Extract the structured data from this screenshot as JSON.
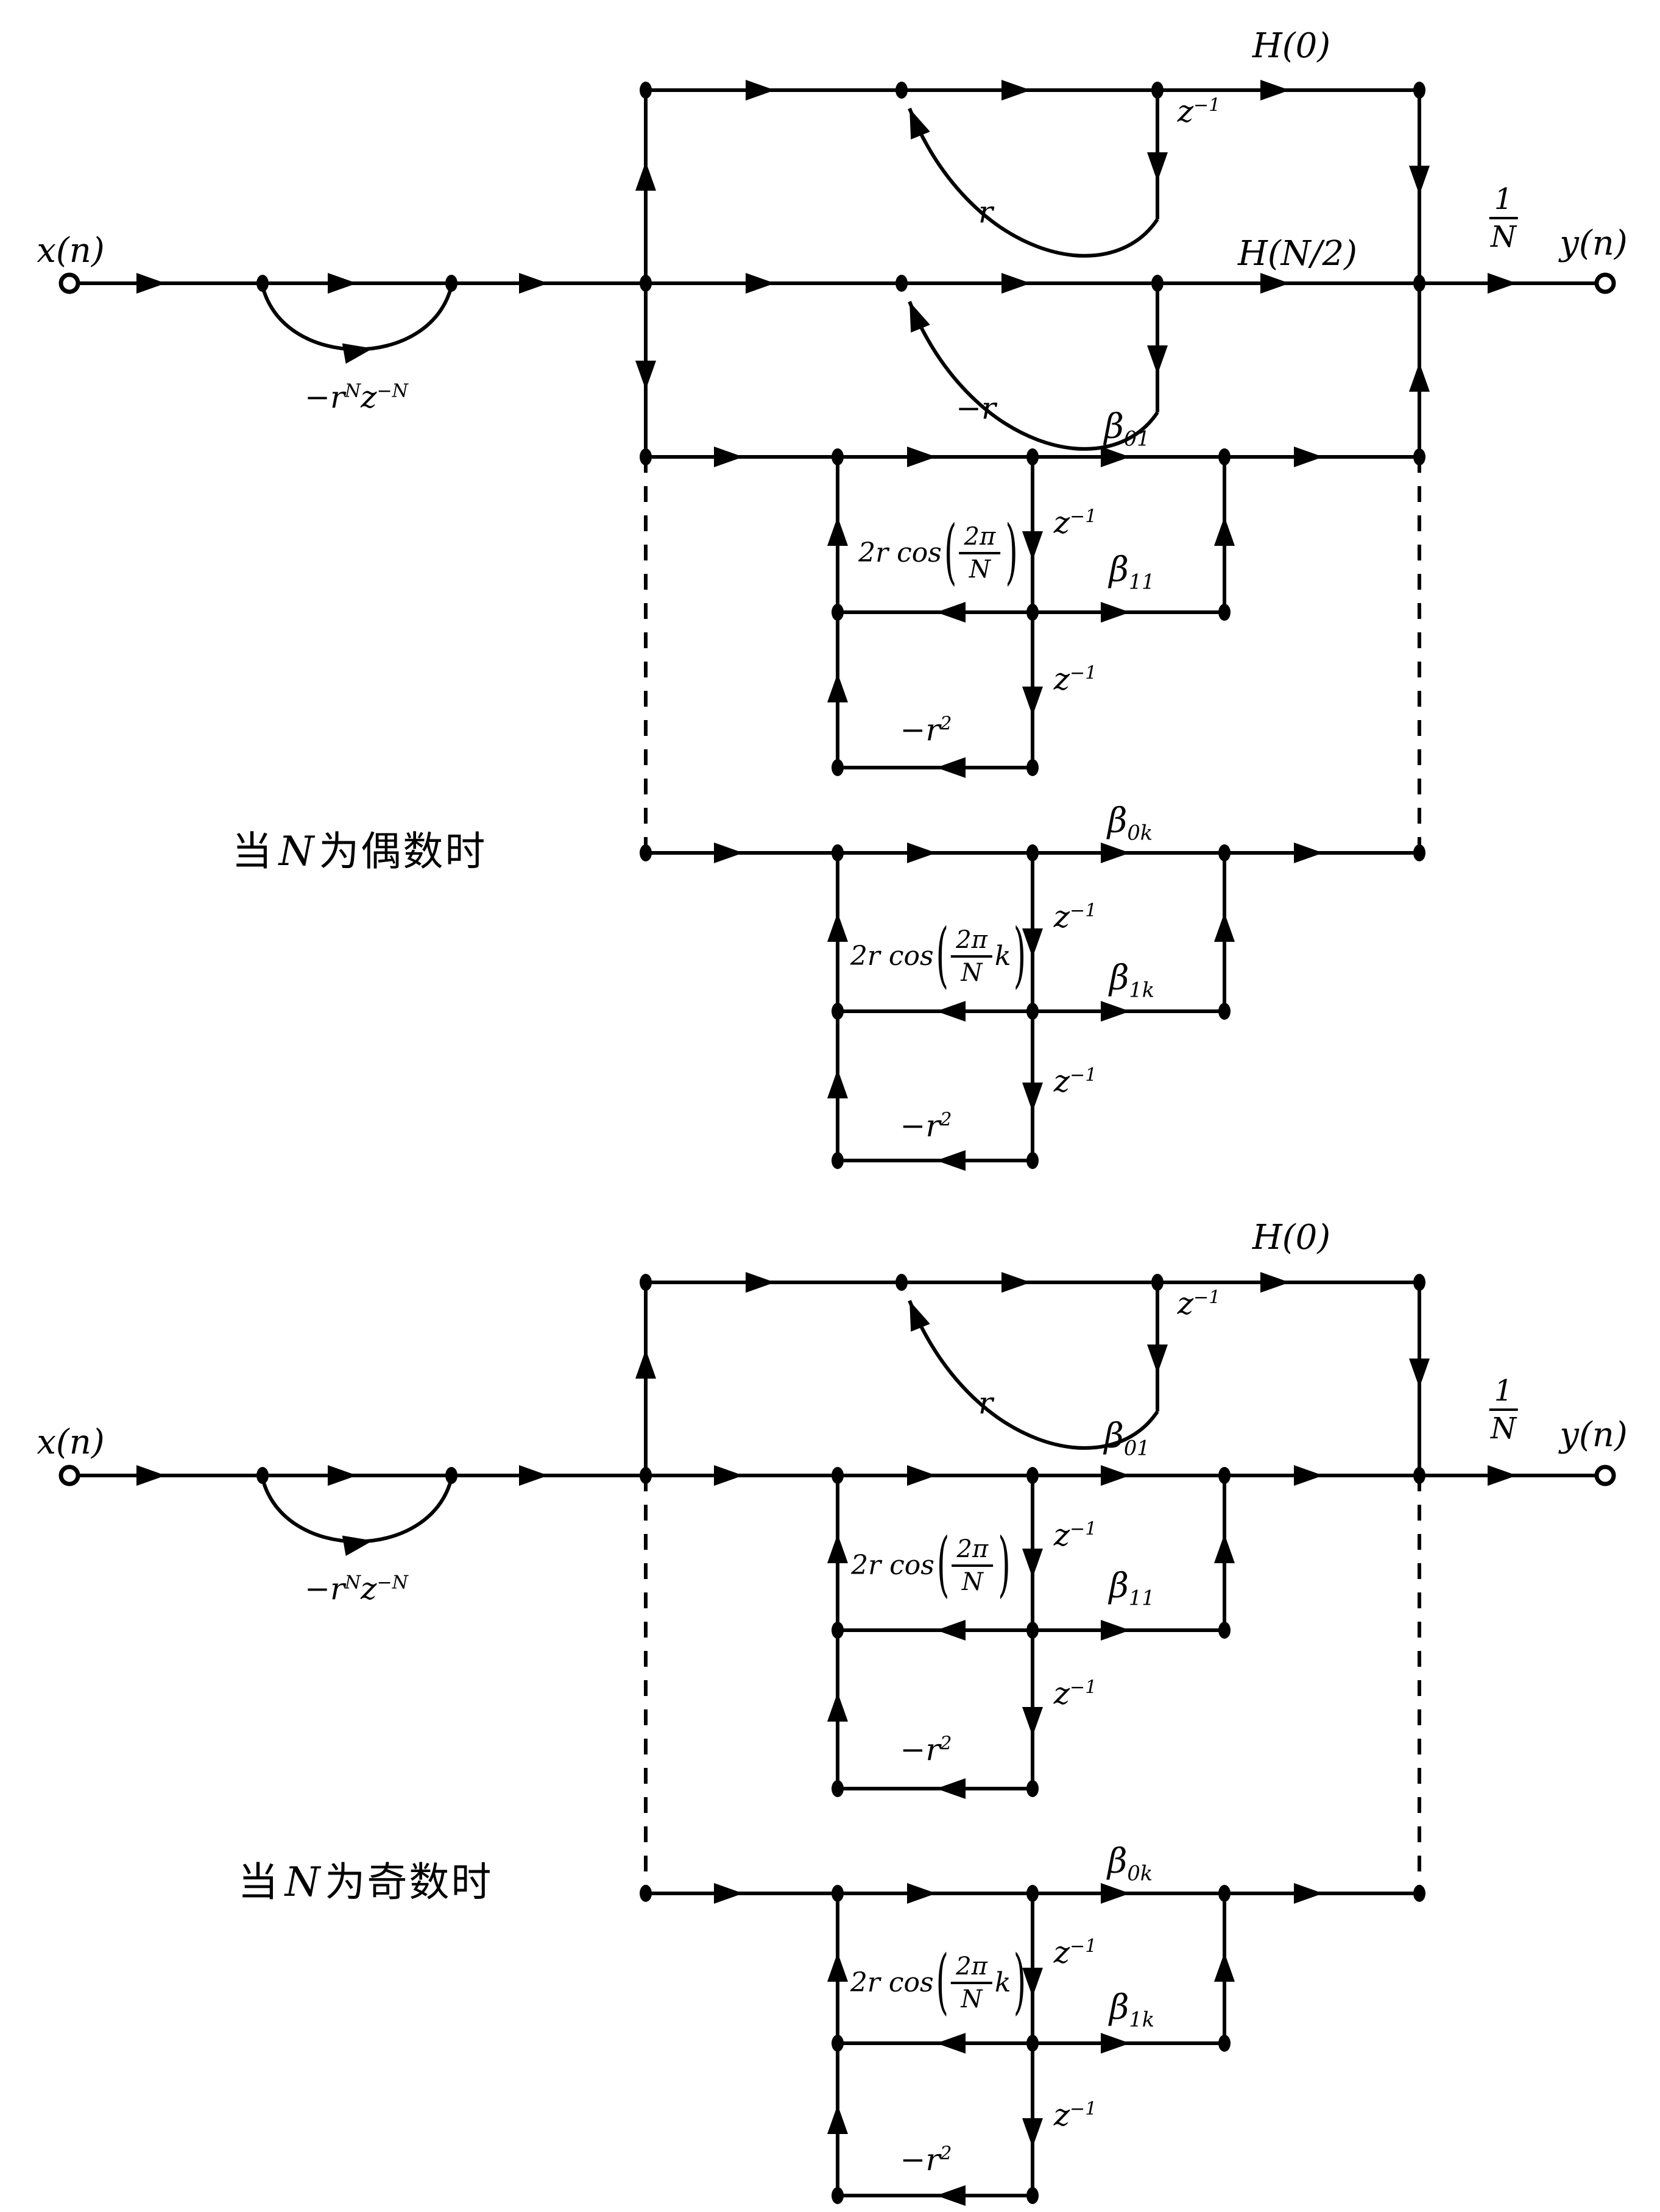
{
  "diagrams": {
    "even": {
      "caption": {
        "pre": "当",
        "n": "N",
        "post": "为偶数时"
      }
    },
    "odd": {
      "caption": {
        "pre": "当",
        "n": "N",
        "post": "为奇数时"
      }
    }
  },
  "labels": {
    "input": "x(n)",
    "output": "y(n)",
    "comb_gain": {
      "b1": "−r",
      "s1": "N",
      "b2": "z",
      "s2": "−N"
    },
    "h0": "H(0)",
    "hn2": "H(N/2)",
    "z_inv": {
      "b": "z",
      "s": "−1"
    },
    "r_pos": "r",
    "r_neg": "−r",
    "r2_neg": {
      "b": "−r",
      "s": "2"
    },
    "beta01": {
      "b": "β",
      "s": "01"
    },
    "beta11": {
      "b": "β",
      "s": "11"
    },
    "beta0k": {
      "b": "β",
      "s": "0k"
    },
    "beta1k": {
      "b": "β",
      "s": "1k"
    },
    "gain1": {
      "pre": "2r cos",
      "lp": "(",
      "num": "2π",
      "den": "N",
      "post": "",
      "rp": ")"
    },
    "gaink": {
      "pre": "2r cos",
      "lp": "(",
      "num": "2π",
      "den": "N",
      "post": "k",
      "rp": ")"
    },
    "inv_n": {
      "num": "1",
      "den": "N"
    }
  }
}
